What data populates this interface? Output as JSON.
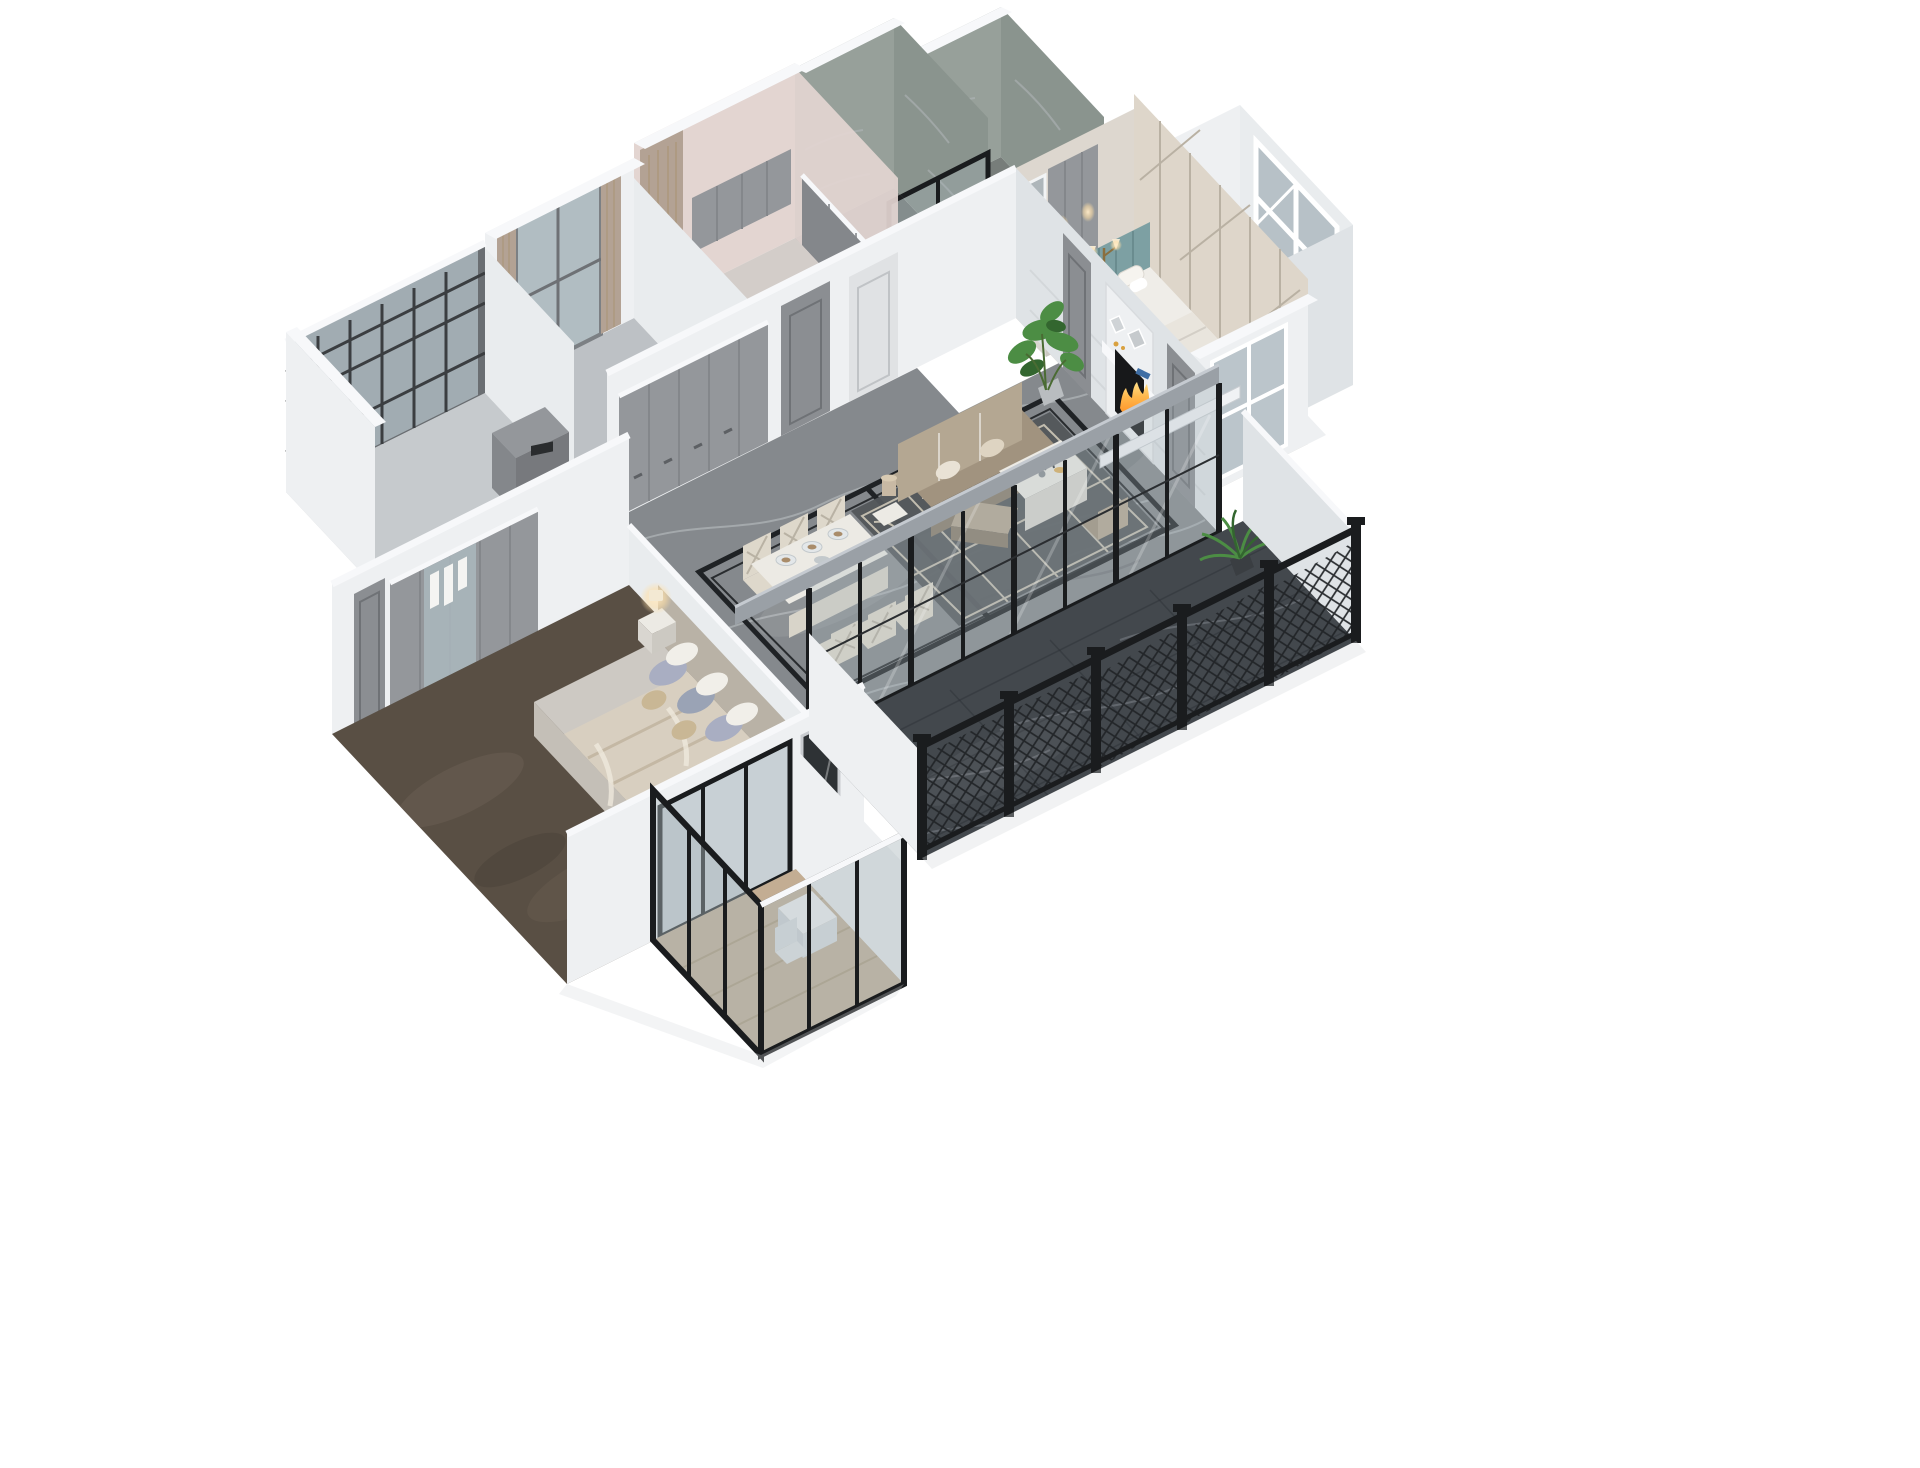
{
  "scene": {
    "description": "Photoreal 3D cutaway dollhouse render of an apartment floor plan viewed from above at an angle, on a plain white background. No text, UI chrome or labels are visible anywhere in the image.",
    "view": "axonometric dollhouse cutaway, viewed from the south-east",
    "background": "#ffffff"
  },
  "palette": {
    "background": "#ffffff",
    "wallWhite": "#eef0f2",
    "wallFace": "#e9ecee",
    "wallShade": "#dfe3e6",
    "wallTop": "#f7f8fa",
    "beamGray": "#9aa0a6",
    "floorGray": "#c6cacd",
    "studyFloor": "#bdc1c5",
    "marbleHall": "#85898d",
    "marbleVeinLight": "#b6babd",
    "marbleVeinDark": "#5e6266",
    "inlayBlack": "#1f2225",
    "balconyFloor": "#43484d",
    "balconyVein": "#7b8288",
    "carpetBrown": "#594f44",
    "woodFloor": "#c3ad93",
    "woodLine": "#a8926f",
    "cabinetGray": "#94979b",
    "cabinetDark": "#84878b",
    "counterLight": "#d8dadc",
    "doorGray": "#8b8e92",
    "doorWhite": "#e0e2e4",
    "glassTint": "#aab7bd",
    "frameBlack": "#1a1c1e",
    "mullionDark": "#2a2d30",
    "sofaTaupe": "#a1937f",
    "sofaLight": "#b4a792",
    "sofaDark": "#8a7d6b",
    "rugDark": "#52565a",
    "rugLine": "#cfc8b8",
    "tableCream": "#eceae4",
    "chairCream": "#ded8cb",
    "mantelWhite": "#eef0f2",
    "fireboxBlack": "#17181a",
    "fireOrange": "#ff9b33",
    "fireYellow": "#ffc96b",
    "plantGreen": "#4c8d44",
    "plantDark": "#33662f",
    "bedWhite": "#efede8",
    "mattress": "#cdc9c3",
    "duvetBeige": "#d8cfc0",
    "pillowBlue": "#a9aec2",
    "pillowGray": "#9aa3b5",
    "pillowTan": "#c9b795",
    "headboardTeal": "#7da0a3",
    "accentWall": "#ded6ca",
    "accentLine": "#b9b1a3",
    "lampGlow": "#ffdfa6",
    "bathWall": "#97a09a",
    "bathWallDark": "#8a948e",
    "bathFloor": "#777d7a",
    "kitchenPink": "#e3d5d1",
    "kitchenFloor": "#d3cdc9",
    "curtainTan": "#b3a294",
    "mirror": "#aeb6ba",
    "bedroomFloor": "#cfc9c0"
  },
  "rooms": {
    "laundryBalcony": {
      "label": "Utility balcony with dark lattice screen windows and gray laundry cabinet"
    },
    "study": {
      "label": "Study with curtained window and bookshelf holding colorful books and art print"
    },
    "kitchen": {
      "label": "Kitchen with pink-tinted walls, gray upper and base cabinets and small island"
    },
    "bathroom": {
      "label": "Bathroom with gray-green marble walls and black framed glass door"
    },
    "ensuiteBathroom": {
      "label": "Second bathroom with gray-green marble walls and black framed glass partition"
    },
    "hallway": {
      "label": "Hallway with built-in gray paneled wardrobe cabinets and doors"
    },
    "livingDiningHall": {
      "label": "Open living and dining hall with gray marble floor and double black inlay border"
    },
    "diningArea": {
      "label": "Cream dining table for six with cross-back chairs and set plates"
    },
    "livingArea": {
      "label": "Taupe leather sofa with ottoman, side lamp table, white coffee table and trellis rug"
    },
    "fireplace": {
      "label": "White mantel fireplace with burning fire, books and decor objects"
    },
    "secondBedroom": {
      "label": "Bedroom with teal tufted headboard, white bedding, glowing lamps and geometric accent wall"
    },
    "bayWindow": {
      "label": "White bay window volume with white lattice glazing"
    },
    "masterBedroom": {
      "label": "Master bedroom with glass-front wardrobe, gray and beige bed, nightstand lamp and brown carpet"
    },
    "masterBalcony": {
      "label": "Glazed bedroom balcony with wood floor, small white desk and chair"
    },
    "mainBalcony": {
      "label": "Long balcony with dark marble floor, black framed glass sliding wall and black lattice railing"
    },
    "plants": {
      "label": "Green monstera and palm plants in pots"
    }
  }
}
